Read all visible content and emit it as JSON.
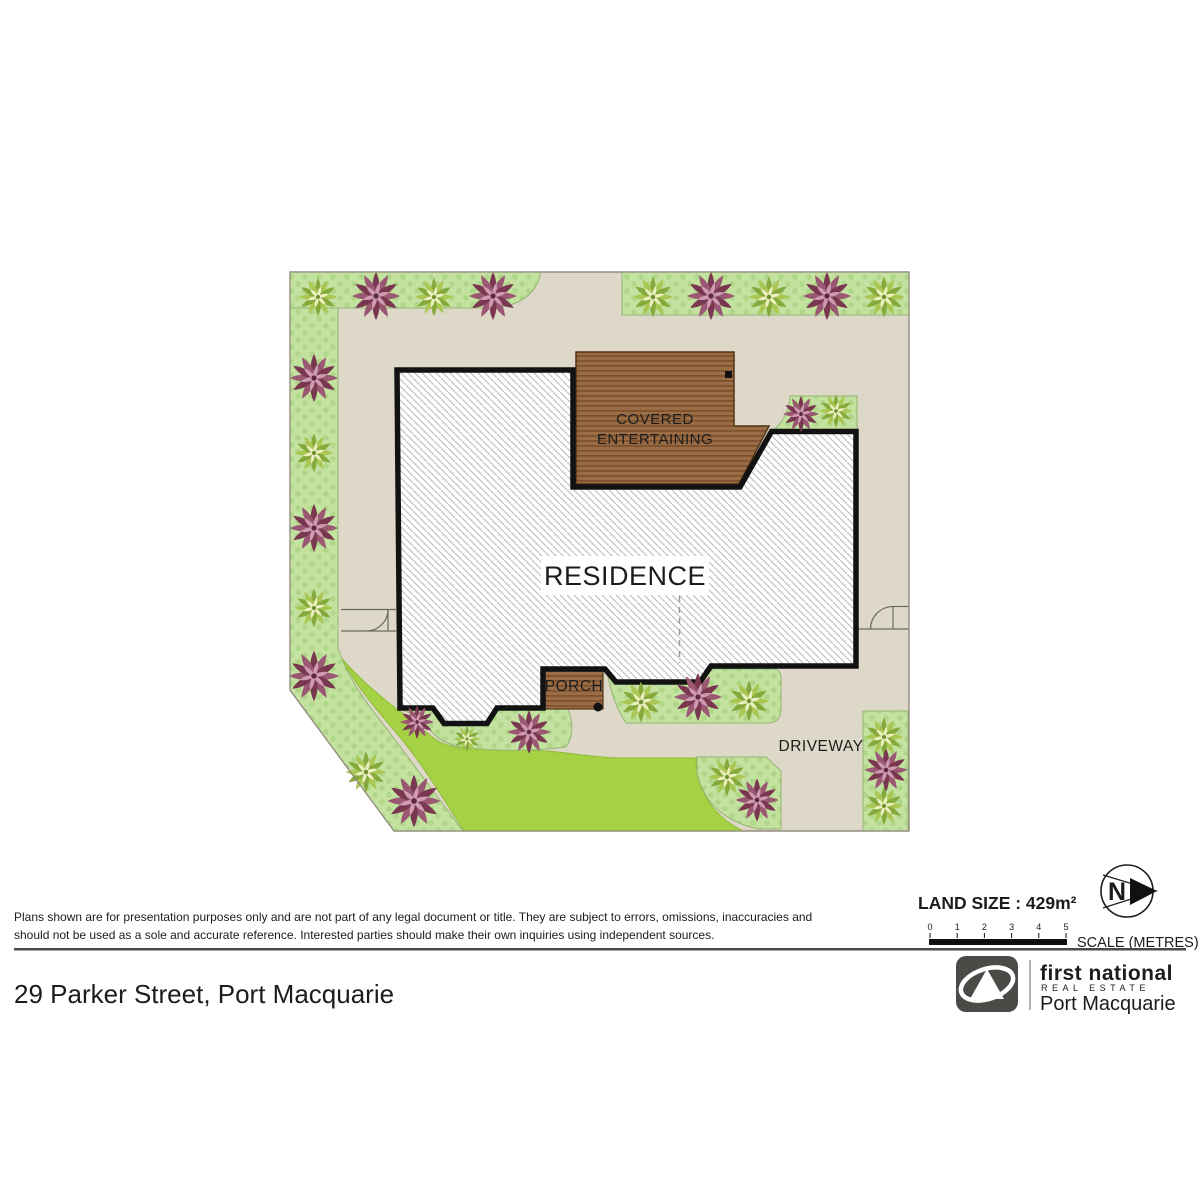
{
  "plan": {
    "residence_label": "RESIDENCE",
    "covered_entertaining_line1": "COVERED",
    "covered_entertaining_line2": "ENTERTAINING",
    "porch_label": "PORCH",
    "driveway_label": "DRIVEWAY",
    "plants": [
      {
        "type": "green",
        "x": 318,
        "y": 297,
        "s": 0.8
      },
      {
        "type": "purple",
        "x": 376,
        "y": 296,
        "s": 1.0
      },
      {
        "type": "green",
        "x": 434,
        "y": 297,
        "s": 0.8
      },
      {
        "type": "purple",
        "x": 493,
        "y": 296,
        "s": 1.0
      },
      {
        "type": "green",
        "x": 653,
        "y": 297,
        "s": 0.85
      },
      {
        "type": "purple",
        "x": 711,
        "y": 296,
        "s": 1.0
      },
      {
        "type": "green",
        "x": 769,
        "y": 297,
        "s": 0.85
      },
      {
        "type": "purple",
        "x": 827,
        "y": 296,
        "s": 1.0
      },
      {
        "type": "green",
        "x": 884,
        "y": 297,
        "s": 0.85
      },
      {
        "type": "purple",
        "x": 314,
        "y": 378,
        "s": 1.0
      },
      {
        "type": "green",
        "x": 314,
        "y": 453,
        "s": 0.8
      },
      {
        "type": "purple",
        "x": 314,
        "y": 528,
        "s": 1.0
      },
      {
        "type": "green",
        "x": 314,
        "y": 608,
        "s": 0.8
      },
      {
        "type": "purple",
        "x": 314,
        "y": 676,
        "s": 1.05
      },
      {
        "type": "green",
        "x": 366,
        "y": 772,
        "s": 0.85
      },
      {
        "type": "purple",
        "x": 414,
        "y": 801,
        "s": 1.1
      },
      {
        "type": "purple",
        "x": 417,
        "y": 722,
        "s": 0.7
      },
      {
        "type": "green",
        "x": 467,
        "y": 739,
        "s": 0.55
      },
      {
        "type": "purple",
        "x": 529,
        "y": 732,
        "s": 0.9
      },
      {
        "type": "green",
        "x": 641,
        "y": 702,
        "s": 0.85
      },
      {
        "type": "purple",
        "x": 698,
        "y": 697,
        "s": 1.0
      },
      {
        "type": "green",
        "x": 749,
        "y": 701,
        "s": 0.85
      },
      {
        "type": "green",
        "x": 727,
        "y": 777,
        "s": 0.8
      },
      {
        "type": "purple",
        "x": 757,
        "y": 800,
        "s": 0.9
      },
      {
        "type": "green",
        "x": 884,
        "y": 737,
        "s": 0.8
      },
      {
        "type": "purple",
        "x": 886,
        "y": 770,
        "s": 0.9
      },
      {
        "type": "green",
        "x": 884,
        "y": 806,
        "s": 0.8
      },
      {
        "type": "purple",
        "x": 801,
        "y": 414,
        "s": 0.75
      },
      {
        "type": "green",
        "x": 836,
        "y": 411,
        "s": 0.7
      }
    ]
  },
  "legend": {
    "land_size": "LAND SIZE : 429m²",
    "scale_label": "SCALE (METRES)",
    "scale_ticks": [
      "0",
      "1",
      "2",
      "3",
      "4",
      "5"
    ],
    "compass_letter": "N"
  },
  "footer": {
    "disclaimer_line1": "Plans shown are for presentation purposes only and are not part of any legal document or title. They are subject to errors, omissions, inaccuracies and",
    "disclaimer_line2": "should not be used as a sole and accurate reference. Interested parties should make their own inquiries using independent sources.",
    "address": "29 Parker Street, Port Macquarie"
  },
  "brand": {
    "name": "first national",
    "tagline": "REAL ESTATE",
    "office": "Port Macquarie"
  },
  "colors": {
    "ground_beige": "#ded8c9",
    "garden_green": "#c3e2a0",
    "garden_dot": "#b0d689",
    "lawn_green": "#a4d244",
    "deck_brown": "#9c6c44",
    "deck_stripe": "#7b5330",
    "house_outline": "#121212",
    "hatch_gray": "#b8b8b8",
    "text_dark": "#1c1c1c",
    "brand_dark": "#4f4e4b",
    "brand_gray": "#8e8d8a"
  }
}
